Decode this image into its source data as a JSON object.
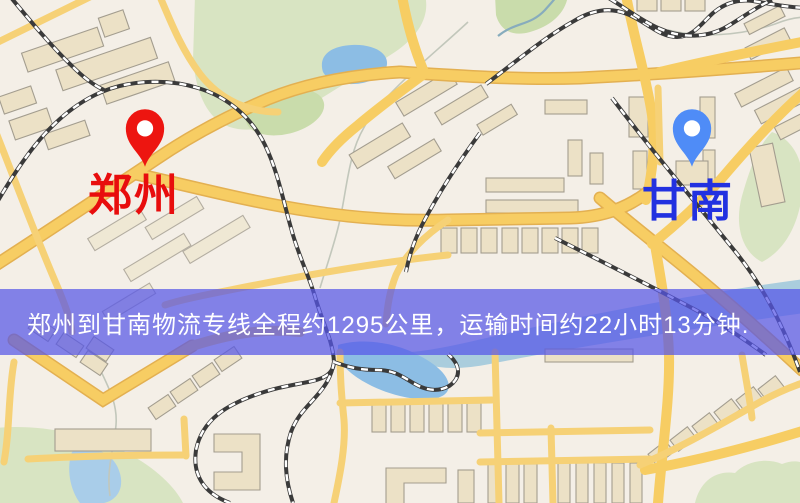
{
  "banner": {
    "text": "郑州到甘南物流专线全程约1295公里，运输时间约22小时13分钟.",
    "background_color": "rgba(86,86,232,0.72)",
    "text_color": "#ffffff"
  },
  "markers": {
    "origin": {
      "label": "郑州",
      "icon": "location-pin",
      "pin_color": "#ed1510",
      "label_color": "#e80d0d"
    },
    "destination": {
      "label": "甘南",
      "icon": "location-pin",
      "pin_color": "#4f8cf7",
      "label_color": "#2231e0"
    }
  },
  "map_palette": {
    "background": "#f4efe7",
    "road": "#f7cd63",
    "road_casing": "#e3b051",
    "railway": "#3a3a3a",
    "park": "#d8e4c2",
    "water": "#8cbde4",
    "building": "#ece1c6"
  }
}
